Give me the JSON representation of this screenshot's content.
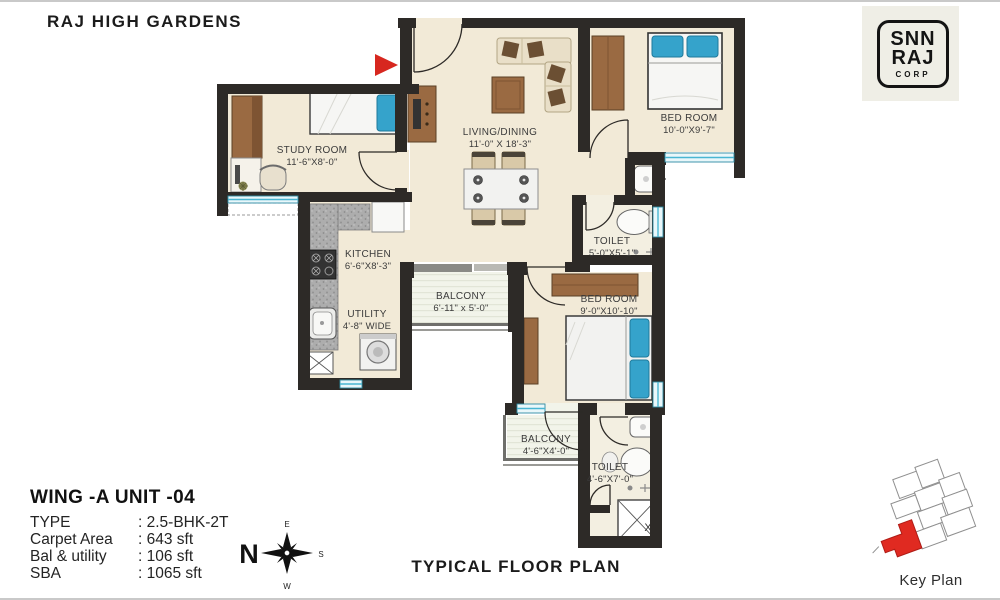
{
  "header": {
    "title": "RAJ HIGH GARDENS"
  },
  "logo": {
    "line1": "SNN",
    "line2": "RAJ",
    "line3": "CORP"
  },
  "rooms": {
    "study": {
      "name": "STUDY ROOM",
      "dims": "11'-6\"X8'-0\""
    },
    "living": {
      "name": "LIVING/DINING",
      "dims": "11'-0\" X 18'-3\""
    },
    "bedroom1": {
      "name": "BED ROOM",
      "dims": "10'-0\"X9'-7\""
    },
    "toilet1": {
      "name": "TOILET",
      "dims": "5'-0\"X5'-1\""
    },
    "kitchen": {
      "name": "KITCHEN",
      "dims": "6'-6\"X8'-3\""
    },
    "utility": {
      "name": "UTILITY",
      "dims": "4'-8\" WIDE"
    },
    "balcony1": {
      "name": "BALCONY",
      "dims": "6'-11\" x 5'-0\""
    },
    "bedroom2": {
      "name": "BED ROOM",
      "dims": "9'-0\"X10'-10\""
    },
    "balcony2": {
      "name": "BALCONY",
      "dims": "4'-6\"X4'-0\""
    },
    "toilet2": {
      "name": "TOILET",
      "dims": "4'-6\"X7'-0\""
    }
  },
  "unit_info": {
    "heading": "WING -A UNIT -04",
    "rows": [
      {
        "label": "TYPE",
        "value": ": 2.5-BHK-2T"
      },
      {
        "label": "Carpet Area",
        "value": ": 643 sft"
      },
      {
        "label": "Bal & utility",
        "value": ": 106 sft"
      },
      {
        "label": "SBA",
        "value": ": 1065 sft"
      }
    ]
  },
  "compass": {
    "north": "N",
    "east": "E",
    "south": "S",
    "west": "W"
  },
  "footer": {
    "plan_title": "TYPICAL FLOOR PLAN"
  },
  "key_plan": {
    "label": "Key Plan"
  },
  "shaft_label": "X",
  "colors": {
    "wall": "#2d2a27",
    "floor": "#f2ead7",
    "window": "#7fd0e4",
    "wood": "#9a6a42",
    "pillow_blue": "#35a3cb",
    "entrance_arrow": "#d7271f",
    "keyplan_highlight": "#e02a21"
  }
}
